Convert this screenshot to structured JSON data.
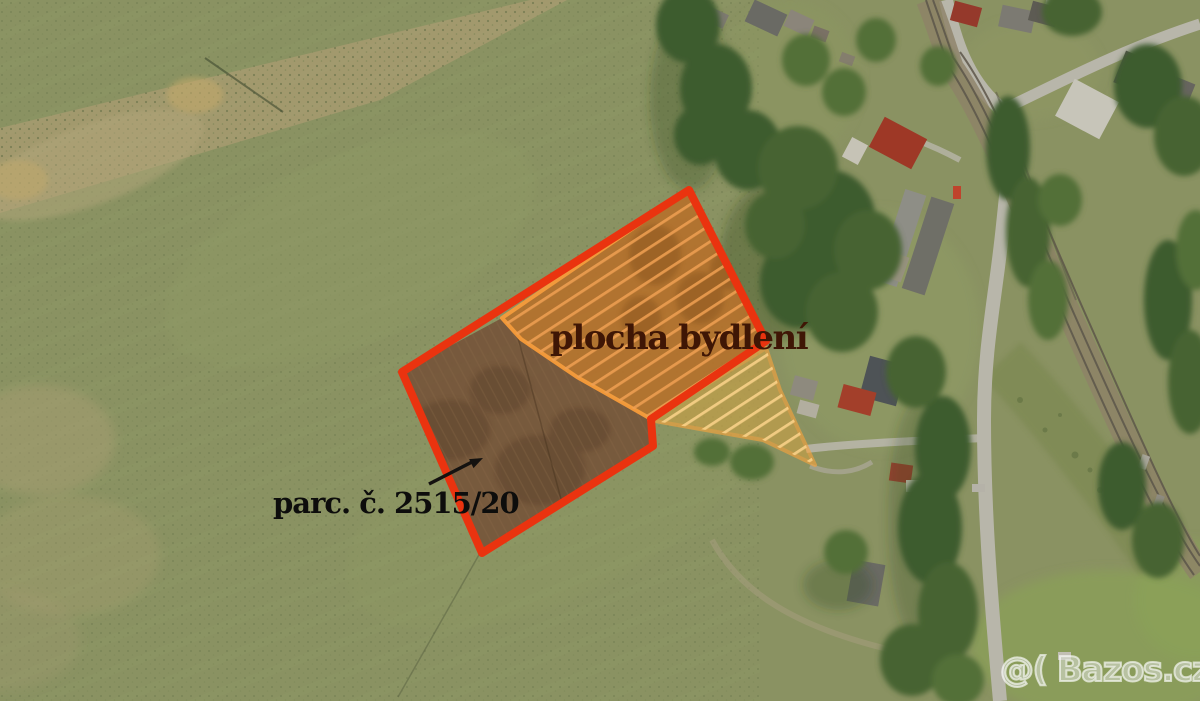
{
  "canvas": {
    "width": 1200,
    "height": 701,
    "description": "aerial photo of meadows and village with highlighted building parcel"
  },
  "annotations": {
    "area_label": {
      "text": "plocha bydlení",
      "color": "#3f1605"
    },
    "parcel_label": {
      "text": "parc. č. 2515/20",
      "color": "#0d0d0c"
    },
    "arrow": {
      "x1": 429,
      "y1": 484,
      "x2": 472,
      "y2": 462,
      "head_points": "483,458 473.5,468.1 469.1,459.1",
      "color": "#141210"
    }
  },
  "watermark": {
    "text": "@( Bazos.cz"
  },
  "overlays": {
    "red_parcel": {
      "points": "689,190 766,341 651,419 653,446 482,553 402,372",
      "stroke": "#ea330f",
      "stroke_width": "8"
    },
    "residential_area": {
      "points": "502,318 689,190 766,341 651,419 623,403 577,377 521,339",
      "fill": "#b4722e",
      "stroke": "#f79b3a",
      "stroke_width": "4"
    },
    "brown_field": {
      "points": "402,372 502,318 521,339 577,377 623,403 651,419 653,446 482,553",
      "fill": "#76563b"
    },
    "yellow_area": {
      "points": "649,420 766,348 780,390 815,465 763,440 700,429",
      "fill": "#caa045",
      "stroke": "#f8a43c",
      "stroke_width": "4"
    }
  },
  "scene_colors": {
    "grass_base": "#8a9262",
    "dry_band": "#a79b70",
    "road": "#b8b6aa",
    "railway_ballast": "#8d8268",
    "rail": "#5d564a",
    "tree_dark": "#3e5b2d",
    "hatch_orange": "#f0a052",
    "hatch_yellow": "#ffd88e"
  }
}
